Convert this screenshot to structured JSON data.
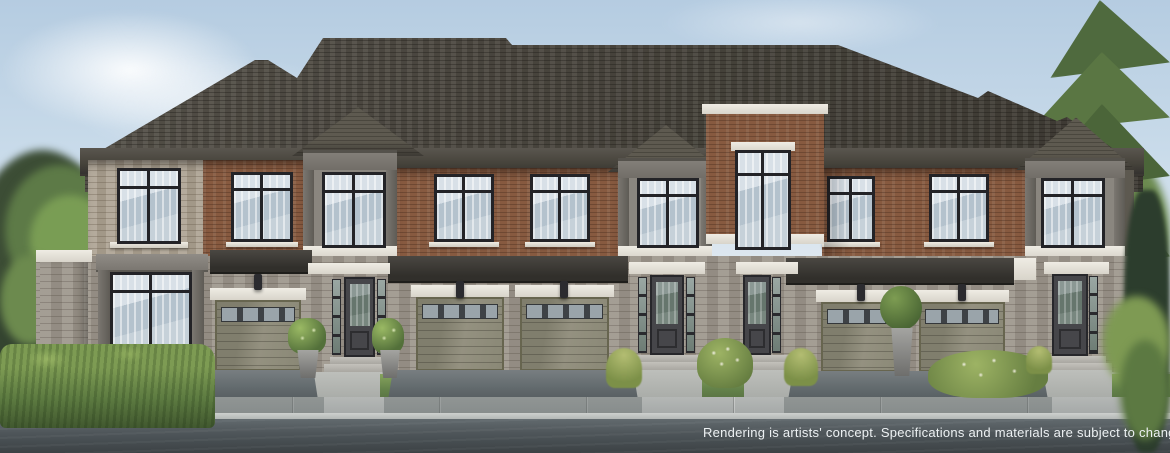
{
  "image": {
    "type": "exterior architectural rendering",
    "subject": "Street elevation of a two-storey brick and stone townhome row with attached garages, landscaped frontage, public sidewalk and road"
  },
  "disclaimer": {
    "text": "Rendering is artists' concept. Specifications and materials are subject to change without notice."
  },
  "scene": {
    "sky": "pale blue with soft clouds",
    "vegetation": [
      "deciduous trees at left edge",
      "tall spruce tree at upper right",
      "evergreen mass at right edge",
      "boxwood hedge at left frontage",
      "planter shrubs flanking entry",
      "ornamental grasses and flowering shrubs"
    ],
    "building": {
      "storeys": 2,
      "visible_garage_doors": 5,
      "visible_entry_doors": 4,
      "visible_upper_windows": 9,
      "features": [
        "charcoal shingle hip roofs",
        "central brick parapet tower with tall window",
        "three projecting grey window bays",
        "white stone lintels and sills",
        "dark metal canopies over garages",
        "wall sconces"
      ]
    },
    "foreground": [
      "front lawns",
      "concrete walkways and steps",
      "asphalt driveways",
      "continuous sidewalk with curb",
      "asphalt road"
    ]
  },
  "palette": {
    "sky_top": "#b5cce1",
    "sky_bottom": "#eef2f4",
    "roof": "#4b473f",
    "fascia": "#45423a",
    "brick": "#875a40",
    "stone_upper": "#aca191",
    "stone_base": "#9b948a",
    "trim_white": "#e9e6de",
    "trim_grey": "#7b7772",
    "window_frame": "#232327",
    "glass": "#c9d4dd",
    "garage_door": "#8b8977",
    "entry_door": "#46464a",
    "hedge": "#5d7b41",
    "grass": "#7d9a56",
    "driveway": "#6d7376",
    "sidewalk": "#aeb2b0",
    "road": "#4b5255",
    "conifer": "#557140",
    "tree_dark": "#3c4d35"
  }
}
